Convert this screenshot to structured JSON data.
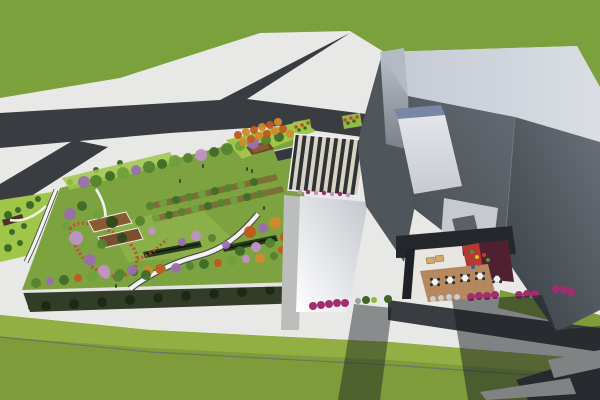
{
  "scene": {
    "description": "Aerial 3D architectural rendering: rooftop garden podium with winding paths and flowering trees, striped pergola canopy, angular gray building with courtyard cafe terrace, surrounding roads, sidewalks and lawns",
    "canvas_width": 600,
    "canvas_height": 400
  },
  "palette": {
    "sidewalk": "#e8e8e6",
    "grass_north": "#7aa13c",
    "grass_south": "#7e9c3a",
    "grass_light_band": "#92af44",
    "grass_divider": "#6e7265",
    "lime": "#9fc648",
    "road": "#393c40",
    "asphalt_corner": "#35383c",
    "garden_base": "#7da341",
    "garden_lawn": "#8db04a",
    "soil": "#7c5a33",
    "hedge_row": "#263a1c",
    "bench": "#11180b",
    "parapet": "#e3e4e1",
    "facade_band": "#323c28",
    "deck_a": "#8a5a33",
    "deck_b": "#7a4e2c",
    "amphitheater": "#6e4526",
    "amphitheater_step": "#8a5a33",
    "kiosk": "#33383c",
    "kiosk_edge": "#cfd3d6",
    "path_white": "#f2f2f0",
    "path_edge": "#4a4a48",
    "red_flowers": "#c24a31",
    "canopy_dark": "#2e3235",
    "canopy_light": "#d8d3c5",
    "gray_path": "#bcbebc",
    "pergola_small": "#4a3526",
    "rim_corner": "#b2bac6",
    "wall_gap": "#4e555b",
    "skylight_strip": "#7787a5",
    "midroof": "#c6cacf",
    "skylight2": "#5a6167",
    "court_shadow": "#24282c",
    "court_white": "#e9e6e1",
    "court_red": "#b23a31",
    "court_maroon": "#512030",
    "court_deck": "#b5885f",
    "court_edge": "#1e2226",
    "lounger": "#d2a96f",
    "table": "#f1f1ef",
    "chair": "#2c2c2c",
    "person": "#2f2f2f",
    "shadow": "#171c21",
    "hedge_bush_a": "#1c2a14",
    "hedge_bush_b": "#2e4022",
    "tree": {
      "g1": "#3f6b2a",
      "g2": "#55832f",
      "g3": "#6fa03b",
      "g4": "#86b24a",
      "p1": "#9a6fae",
      "p2": "#c193c7",
      "o1": "#c05a1f",
      "o2": "#d28a2e",
      "d1": "#2c4a1d"
    },
    "shrub": {
      "m": "#a12d6e",
      "gn": "#3f6527",
      "gr": "#9aa0a0",
      "w": "#c9cdcd",
      "y": "#9ab33c",
      "r": "#c24a31"
    },
    "play": [
      "#3f9e35",
      "#e3bd27",
      "#c63a2c",
      "#2a62b8"
    ]
  },
  "scene_items": {
    "trees": [
      [
        96,
        181,
        6,
        "g2"
      ],
      [
        110,
        176,
        5,
        "g1"
      ],
      [
        123,
        173,
        6,
        "g3"
      ],
      [
        136,
        170,
        5,
        "p1"
      ],
      [
        149,
        167,
        6,
        "g2"
      ],
      [
        162,
        164,
        5,
        "g1"
      ],
      [
        175,
        161,
        6,
        "g3"
      ],
      [
        188,
        158,
        5,
        "g2"
      ],
      [
        201,
        155,
        6,
        "p2"
      ],
      [
        214,
        152,
        5,
        "g1"
      ],
      [
        227,
        149,
        6,
        "g2"
      ],
      [
        240,
        146,
        5,
        "g3"
      ],
      [
        253,
        143,
        6,
        "p1"
      ],
      [
        266,
        140,
        5,
        "g2"
      ],
      [
        279,
        137,
        5,
        "g1"
      ],
      [
        290,
        134,
        4,
        "o2"
      ],
      [
        84,
        182,
        6,
        "p1"
      ],
      [
        36,
        283,
        5,
        "g2"
      ],
      [
        50,
        281,
        4,
        "p1"
      ],
      [
        64,
        280,
        5,
        "g1"
      ],
      [
        78,
        278,
        4,
        "o1"
      ],
      [
        92,
        277,
        5,
        "g3"
      ],
      [
        106,
        275,
        4,
        "p2"
      ],
      [
        120,
        274,
        5,
        "g2"
      ],
      [
        134,
        272,
        4,
        "g1"
      ],
      [
        148,
        271,
        5,
        "o2"
      ],
      [
        162,
        269,
        4,
        "g3"
      ],
      [
        176,
        268,
        5,
        "p1"
      ],
      [
        190,
        266,
        4,
        "g2"
      ],
      [
        204,
        264,
        5,
        "g1"
      ],
      [
        218,
        263,
        4,
        "o1"
      ],
      [
        232,
        261,
        5,
        "g3"
      ],
      [
        246,
        259,
        4,
        "p2"
      ],
      [
        260,
        258,
        5,
        "o2"
      ],
      [
        274,
        256,
        4,
        "g2"
      ],
      [
        288,
        254,
        5,
        "o1"
      ],
      [
        70,
        214,
        6,
        "p1"
      ],
      [
        82,
        206,
        5,
        "g1"
      ],
      [
        76,
        238,
        7,
        "p2"
      ],
      [
        90,
        260,
        6,
        "p1"
      ],
      [
        104,
        271,
        6,
        "p2"
      ],
      [
        118,
        277,
        5,
        "g2"
      ],
      [
        66,
        226,
        4,
        "g3"
      ],
      [
        132,
        270,
        5,
        "p1"
      ],
      [
        146,
        275,
        5,
        "g1"
      ],
      [
        98,
        214,
        5,
        "g3"
      ],
      [
        140,
        221,
        5,
        "g2"
      ],
      [
        152,
        231,
        4,
        "p2"
      ],
      [
        160,
        269,
        5,
        "o1"
      ],
      [
        112,
        222,
        6,
        "d1"
      ],
      [
        122,
        238,
        5,
        "d1"
      ],
      [
        102,
        244,
        5,
        "g2"
      ],
      [
        150,
        206,
        4,
        "g2"
      ],
      [
        163,
        203,
        4,
        "g3"
      ],
      [
        176,
        200,
        4,
        "g1"
      ],
      [
        189,
        197,
        4,
        "g2"
      ],
      [
        202,
        194,
        4,
        "g3"
      ],
      [
        215,
        191,
        4,
        "g1"
      ],
      [
        228,
        188,
        4,
        "g2"
      ],
      [
        241,
        185,
        4,
        "g3"
      ],
      [
        254,
        182,
        4,
        "g1"
      ],
      [
        156,
        218,
        4,
        "g3"
      ],
      [
        169,
        215,
        4,
        "g1"
      ],
      [
        182,
        212,
        4,
        "g2"
      ],
      [
        195,
        209,
        4,
        "g3"
      ],
      [
        208,
        206,
        4,
        "g1"
      ],
      [
        221,
        203,
        4,
        "g2"
      ],
      [
        234,
        200,
        4,
        "g3"
      ],
      [
        247,
        197,
        4,
        "g1"
      ],
      [
        260,
        194,
        4,
        "g2"
      ],
      [
        250,
        232,
        6,
        "o1"
      ],
      [
        263,
        228,
        5,
        "p1"
      ],
      [
        275,
        223,
        6,
        "o2"
      ],
      [
        285,
        237,
        5,
        "o1"
      ],
      [
        270,
        243,
        5,
        "g2"
      ],
      [
        256,
        247,
        5,
        "p2"
      ],
      [
        240,
        251,
        5,
        "g1"
      ],
      [
        226,
        245,
        4,
        "p1"
      ],
      [
        289,
        219,
        5,
        "g3"
      ],
      [
        293,
        239,
        4,
        "o2"
      ],
      [
        212,
        238,
        4,
        "g2"
      ],
      [
        196,
        236,
        5,
        "p2"
      ],
      [
        182,
        242,
        4,
        "p1"
      ],
      [
        282,
        250,
        4,
        "o1"
      ],
      [
        238,
        135,
        4,
        "o1"
      ],
      [
        246,
        132,
        4,
        "o2"
      ],
      [
        254,
        130,
        4,
        "o1"
      ],
      [
        262,
        127,
        4,
        "o2"
      ],
      [
        270,
        125,
        4,
        "o1"
      ],
      [
        278,
        122,
        4,
        "o2"
      ],
      [
        243,
        142,
        4,
        "o2"
      ],
      [
        251,
        139,
        4,
        "o1"
      ],
      [
        259,
        136,
        4,
        "o2"
      ],
      [
        267,
        134,
        4,
        "o1"
      ],
      [
        275,
        131,
        4,
        "o2"
      ],
      [
        283,
        129,
        4,
        "o1"
      ]
    ],
    "park_bushes": [
      [
        8,
        215,
        4
      ],
      [
        18,
        210,
        3
      ],
      [
        30,
        205,
        4
      ],
      [
        12,
        232,
        3
      ],
      [
        24,
        226,
        3
      ],
      [
        38,
        199,
        3
      ],
      [
        8,
        248,
        4
      ],
      [
        20,
        243,
        3
      ],
      [
        70,
        182,
        3
      ],
      [
        96,
        170,
        3
      ],
      [
        120,
        163,
        3
      ]
    ],
    "hedge_bushes": [
      [
        32,
        307
      ],
      [
        46,
        306
      ],
      [
        60,
        305
      ],
      [
        74,
        304
      ],
      [
        88,
        303
      ],
      [
        102,
        302
      ],
      [
        116,
        301
      ],
      [
        130,
        300
      ],
      [
        144,
        299
      ],
      [
        158,
        298
      ],
      [
        172,
        297
      ],
      [
        186,
        296
      ],
      [
        200,
        295
      ],
      [
        214,
        294
      ],
      [
        228,
        293
      ],
      [
        242,
        292
      ],
      [
        256,
        291
      ],
      [
        270,
        290
      ],
      [
        284,
        289
      ],
      [
        294,
        288
      ]
    ],
    "shrub_row": [
      [
        313,
        306,
        4,
        "m"
      ],
      [
        321,
        305,
        4,
        "m"
      ],
      [
        329,
        304,
        4,
        "m"
      ],
      [
        337,
        303,
        4,
        "m"
      ],
      [
        345,
        303,
        4,
        "m"
      ],
      [
        358,
        301,
        3,
        "gr"
      ],
      [
        366,
        300,
        4,
        "gn"
      ],
      [
        374,
        300,
        3,
        "y"
      ],
      [
        388,
        299,
        4,
        "gn"
      ],
      [
        433,
        299,
        3,
        "w"
      ],
      [
        441,
        298,
        3,
        "w"
      ],
      [
        449,
        297,
        3,
        "w"
      ],
      [
        457,
        297,
        3,
        "w"
      ],
      [
        471,
        297,
        4,
        "m"
      ],
      [
        479,
        296,
        4,
        "m"
      ],
      [
        487,
        296,
        4,
        "m"
      ],
      [
        495,
        295,
        4,
        "m"
      ],
      [
        519,
        295,
        4,
        "m"
      ],
      [
        527,
        294,
        4,
        "m"
      ],
      [
        535,
        294,
        4,
        "m"
      ],
      [
        556,
        289,
        4,
        "m"
      ],
      [
        564,
        290,
        4,
        "m"
      ],
      [
        571,
        292,
        4,
        "m"
      ]
    ],
    "verge_dots": [
      [
        296,
        127,
        "r"
      ],
      [
        302,
        125,
        "r"
      ],
      [
        308,
        123,
        "r"
      ],
      [
        345,
        120,
        "r"
      ],
      [
        351,
        118,
        "r"
      ],
      [
        357,
        117,
        "r"
      ],
      [
        299,
        130,
        "gn"
      ],
      [
        305,
        128,
        "gn"
      ],
      [
        348,
        123,
        "gn"
      ],
      [
        354,
        121,
        "gn"
      ]
    ],
    "planter_dots": [
      [
        300,
        192
      ],
      [
        308,
        192
      ],
      [
        316,
        193
      ],
      [
        324,
        193
      ],
      [
        332,
        194
      ],
      [
        340,
        194
      ],
      [
        348,
        195
      ]
    ],
    "canopy": {
      "stripe_count": 18,
      "top_left": [
        295,
        134
      ],
      "top_right": [
        366,
        140
      ],
      "bottom_left": [
        288,
        190
      ],
      "bottom_right": [
        358,
        196
      ]
    },
    "tables": [
      [
        435,
        282
      ],
      [
        450,
        280
      ],
      [
        465,
        278
      ],
      [
        480,
        276
      ],
      [
        497,
        279
      ]
    ],
    "play_items": [
      [
        472,
        252,
        0
      ],
      [
        477,
        257,
        1
      ],
      [
        479,
        264,
        2
      ],
      [
        473,
        267,
        3
      ],
      [
        484,
        255,
        2
      ],
      [
        488,
        260,
        0
      ]
    ],
    "people": [
      [
        203,
        166
      ],
      [
        247,
        169
      ],
      [
        252,
        171
      ],
      [
        180,
        181
      ],
      [
        298,
        214
      ],
      [
        330,
        300
      ],
      [
        432,
        312
      ],
      [
        116,
        286
      ],
      [
        264,
        208
      ]
    ]
  }
}
